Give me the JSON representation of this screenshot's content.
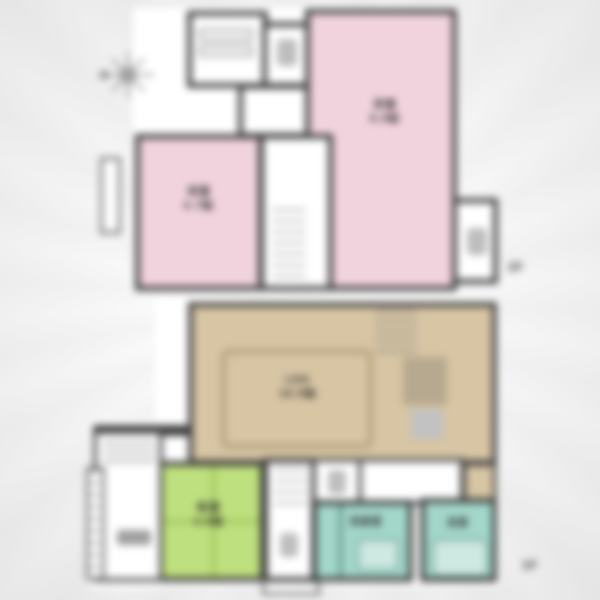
{
  "plan": {
    "floors": [
      {
        "tag": "2F",
        "rooms": [
          {
            "name": "bedroom-right",
            "label": "洋室",
            "size": "8.5帖",
            "color": "#f1d3de"
          },
          {
            "name": "bedroom-left",
            "label": "洋室",
            "size": "6.7帖",
            "color": "#f1d3de"
          },
          {
            "name": "toilet",
            "label": "",
            "color": "#ffffff"
          },
          {
            "name": "closet-room",
            "label": "",
            "color": "#ffffff"
          },
          {
            "name": "balcony",
            "label": "",
            "color": "#ffffff"
          }
        ]
      },
      {
        "tag": "1F",
        "rooms": [
          {
            "name": "ldk",
            "label": "LDK",
            "size": "16.5帖",
            "color": "#d7c5a4"
          },
          {
            "name": "tatami-room",
            "label": "和室",
            "size": "4.5帖",
            "color": "#bfe07e"
          },
          {
            "name": "washroom",
            "label": "洗面室",
            "color": "#a3d7ca"
          },
          {
            "name": "bathroom",
            "label": "浴室",
            "color": "#a3d7ca"
          },
          {
            "name": "entrance",
            "label": "",
            "color": "#ffffff"
          }
        ]
      }
    ]
  },
  "labels": {
    "f2_tag": "2F",
    "f1_tag": "1F",
    "f2_bedroom_right_name": "洋室",
    "f2_bedroom_right_size": "8.5帖",
    "f2_bedroom_left_name": "洋室",
    "f2_bedroom_left_size": "6.7帖",
    "f1_ldk_name": "LDK",
    "f1_ldk_size": "16.5帖",
    "f1_tatami_name": "和室",
    "f1_tatami_size": "4.5帖",
    "f1_washroom": "洗面室",
    "f1_bath": "浴室"
  },
  "colors": {
    "wall": "#3e3e3e",
    "bedroom_pink": "#f1d3de",
    "ldk_tan": "#d7c5a4",
    "tatami_green": "#bfe07e",
    "wet_teal": "#a3d7ca",
    "paper": "#f0f0f0"
  },
  "icons": {
    "compass": "compass-rose"
  }
}
